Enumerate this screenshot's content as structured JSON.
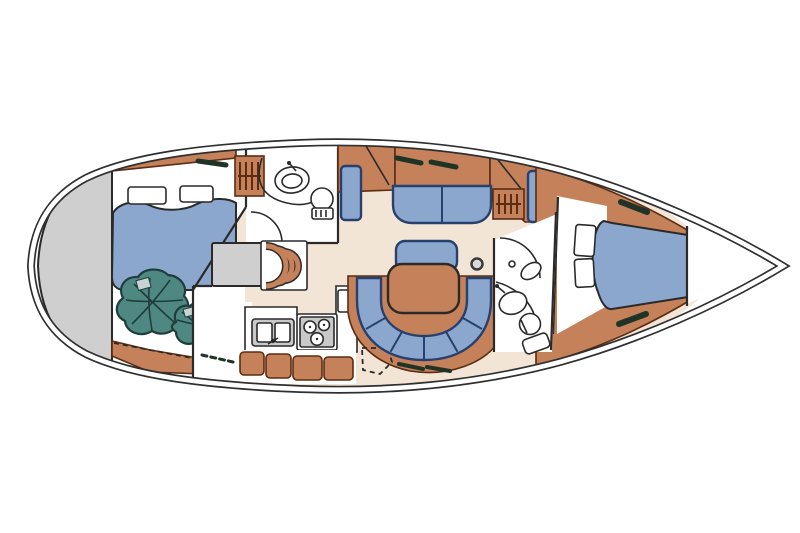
{
  "image": {
    "kind": "boat-floor-plan",
    "canvas": {
      "width": 800,
      "height": 533
    }
  },
  "colors": {
    "hull_line": "#2f2f2f",
    "outline_dark": "#2a2a2a",
    "floor_cream": "#f3e5d5",
    "room_white": "#ffffff",
    "wood": "#c5815a",
    "wood_dark": "#5b2c12",
    "upholstery_blue": "#8ca7ce",
    "upholstery_navy": "#27406e",
    "beanbag_teal": "#4f8782",
    "beanbag_dark": "#1e3d3b",
    "transom_grey": "#cfcfcf",
    "appliance_grey": "#c9c9c9",
    "hatch_dark": "#1f3326",
    "pale_grey": "#c8d4d4"
  },
  "features": [
    "hull-outline-with-toe-rail",
    "stern-platform",
    "aft-cabin-double-berth-with-two-pillows",
    "two-beanbag-chairs",
    "aft-head-with-washbasin-and-toilet",
    "hanging-lockers",
    "companionway-steps-and-engine-box",
    "galley-with-double-sink-and-three-burner-stove",
    "storage-lockers-row",
    "port-straight-settee",
    "dinette-table-with-bench-and-u-shaped-settee",
    "mast-post",
    "forward-head-with-washbasin-and-toilet",
    "v-berth-with-two-pillows",
    "bow-anchor-locker",
    "deck-hatches"
  ]
}
